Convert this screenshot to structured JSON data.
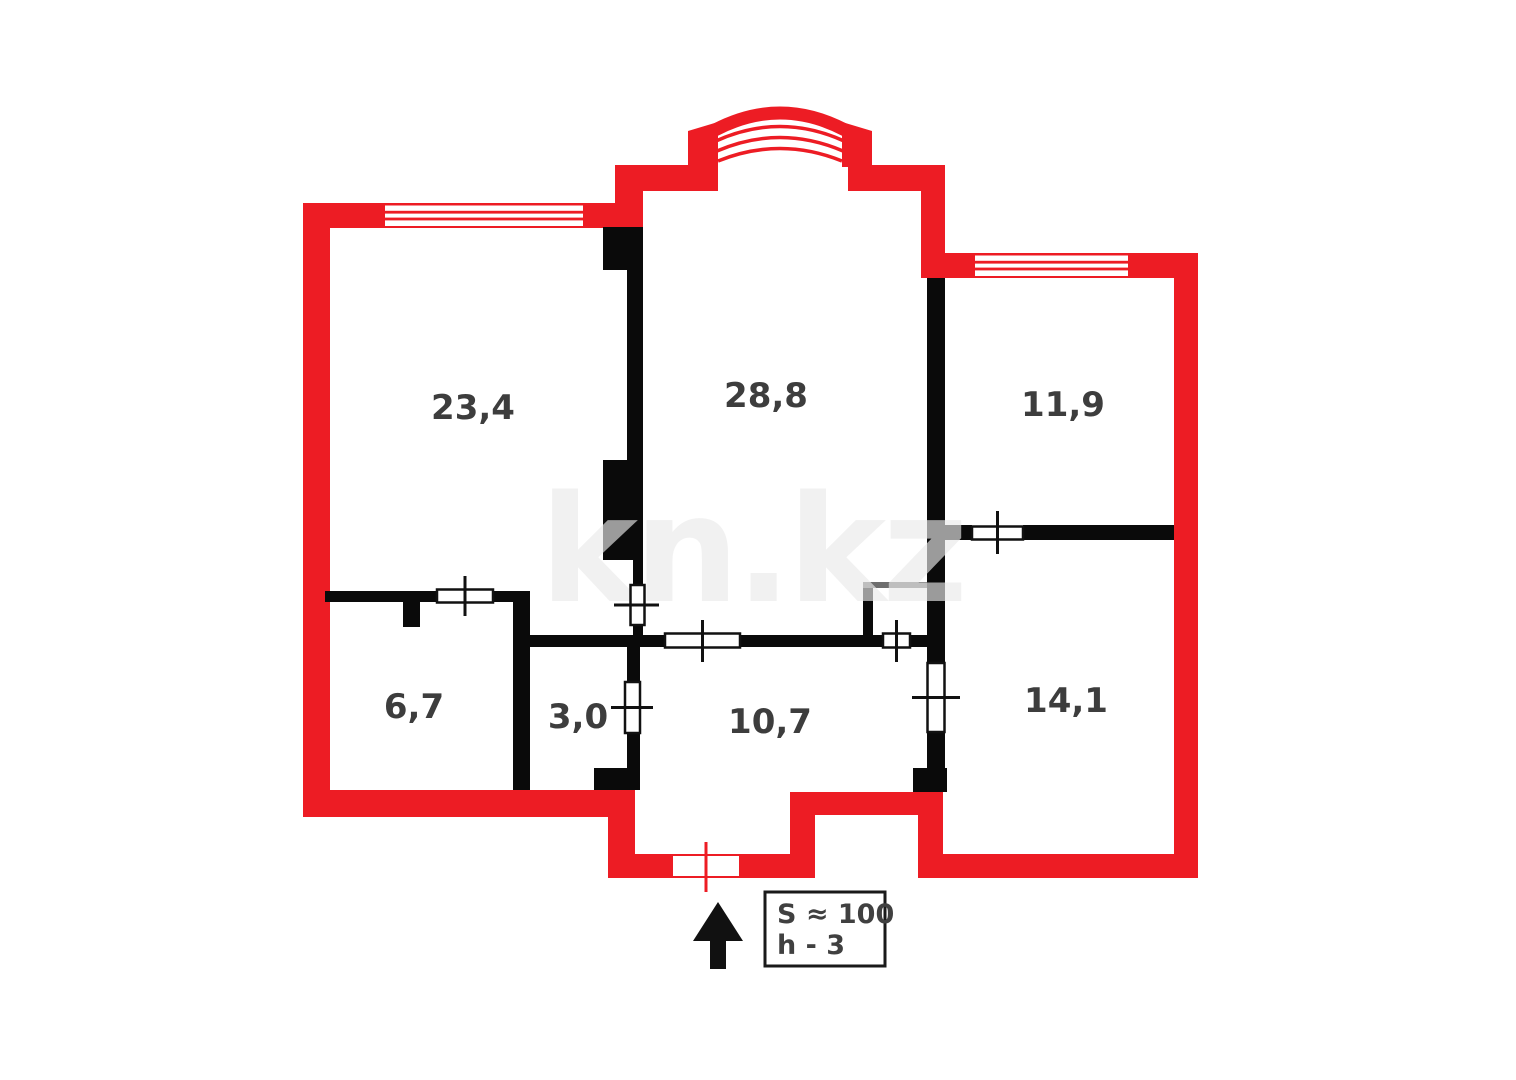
{
  "floorplan": {
    "watermark": "kn.kz",
    "room_areas": [
      "23,4",
      "28,8",
      "11,9",
      "6,7",
      "3,0",
      "10,7",
      "14,1"
    ],
    "info_box": {
      "area_label": "S ≈ 100",
      "height_label": "h - 3"
    },
    "colors": {
      "exterior_wall": "#ed1c24",
      "interior_wall": "#0a0a0a",
      "partition_gray": "#6e6e6e",
      "label_text": "#3d3d3d"
    }
  }
}
